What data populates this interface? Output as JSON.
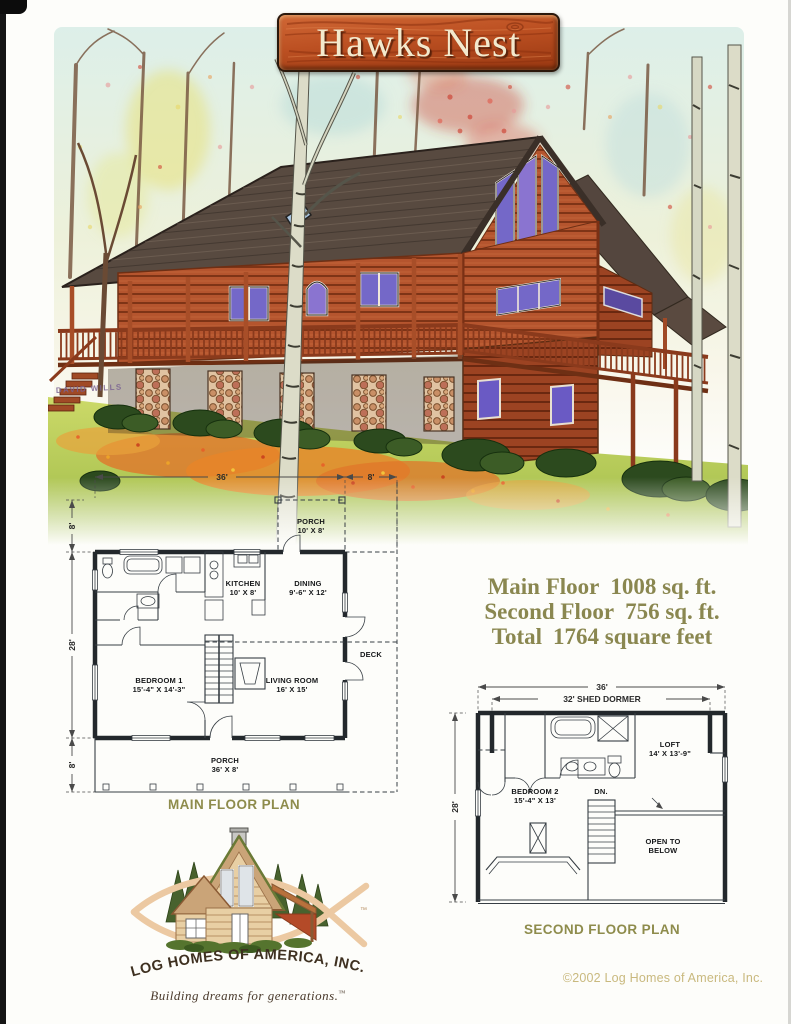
{
  "banner": {
    "title": "Hawks Nest"
  },
  "illustration": {
    "artist_signature": "DAVID WILLS"
  },
  "specs": {
    "rows": [
      {
        "label": "Main Floor",
        "value": "1008 sq. ft."
      },
      {
        "label": "Second Floor",
        "value": "756 sq. ft."
      },
      {
        "label": "Total",
        "value": "1764 square feet"
      }
    ]
  },
  "main_floor_plan": {
    "caption": "MAIN FLOOR PLAN",
    "dims": {
      "width": "36'",
      "deck": "8'",
      "rear_porch": "8'",
      "depth": "28'",
      "front_porch": "8'"
    },
    "rooms": {
      "rear_porch": {
        "name": "PORCH",
        "size": "10' X 8'"
      },
      "kitchen": {
        "name": "KITCHEN",
        "size": "10' X 8'"
      },
      "dining": {
        "name": "DINING",
        "size": "9'-6\" X 12'"
      },
      "deck": {
        "name": "DECK"
      },
      "bedroom1": {
        "name": "BEDROOM 1",
        "size": "15'-4\" X 14'-3\""
      },
      "living": {
        "name": "LIVING ROOM",
        "size": "16' X 15'"
      },
      "front_porch": {
        "name": "PORCH",
        "size": "36' X 8'"
      }
    }
  },
  "second_floor_plan": {
    "caption": "SECOND FLOOR PLAN",
    "dims": {
      "width": "36'",
      "dormer": "32' SHED DORMER",
      "depth": "28'"
    },
    "rooms": {
      "loft": {
        "name": "LOFT",
        "size": "14' X 13'-9\""
      },
      "bedroom2": {
        "name": "BEDROOM 2",
        "size": "15'-4\" X 13'"
      },
      "stairs": {
        "name": "DN."
      },
      "open": {
        "line1": "OPEN TO",
        "line2": "BELOW"
      }
    }
  },
  "logo": {
    "company": "LOG HOMES OF AMERICA, INC.",
    "tagline": "Building dreams for generations.",
    "tm": "™"
  },
  "footer": {
    "copyright": "©2002 Log Homes of America, Inc."
  },
  "colors": {
    "banner_wood": "#bc5022",
    "spec_text": "#8a8750",
    "plan_caption": "#8e8c4c",
    "copyright_text": "#c9b97e",
    "logo_fish": "#ecc9a2",
    "cabin_logs": "#b5552e",
    "roof": "#584a40",
    "window_glass": "#7468c8"
  }
}
